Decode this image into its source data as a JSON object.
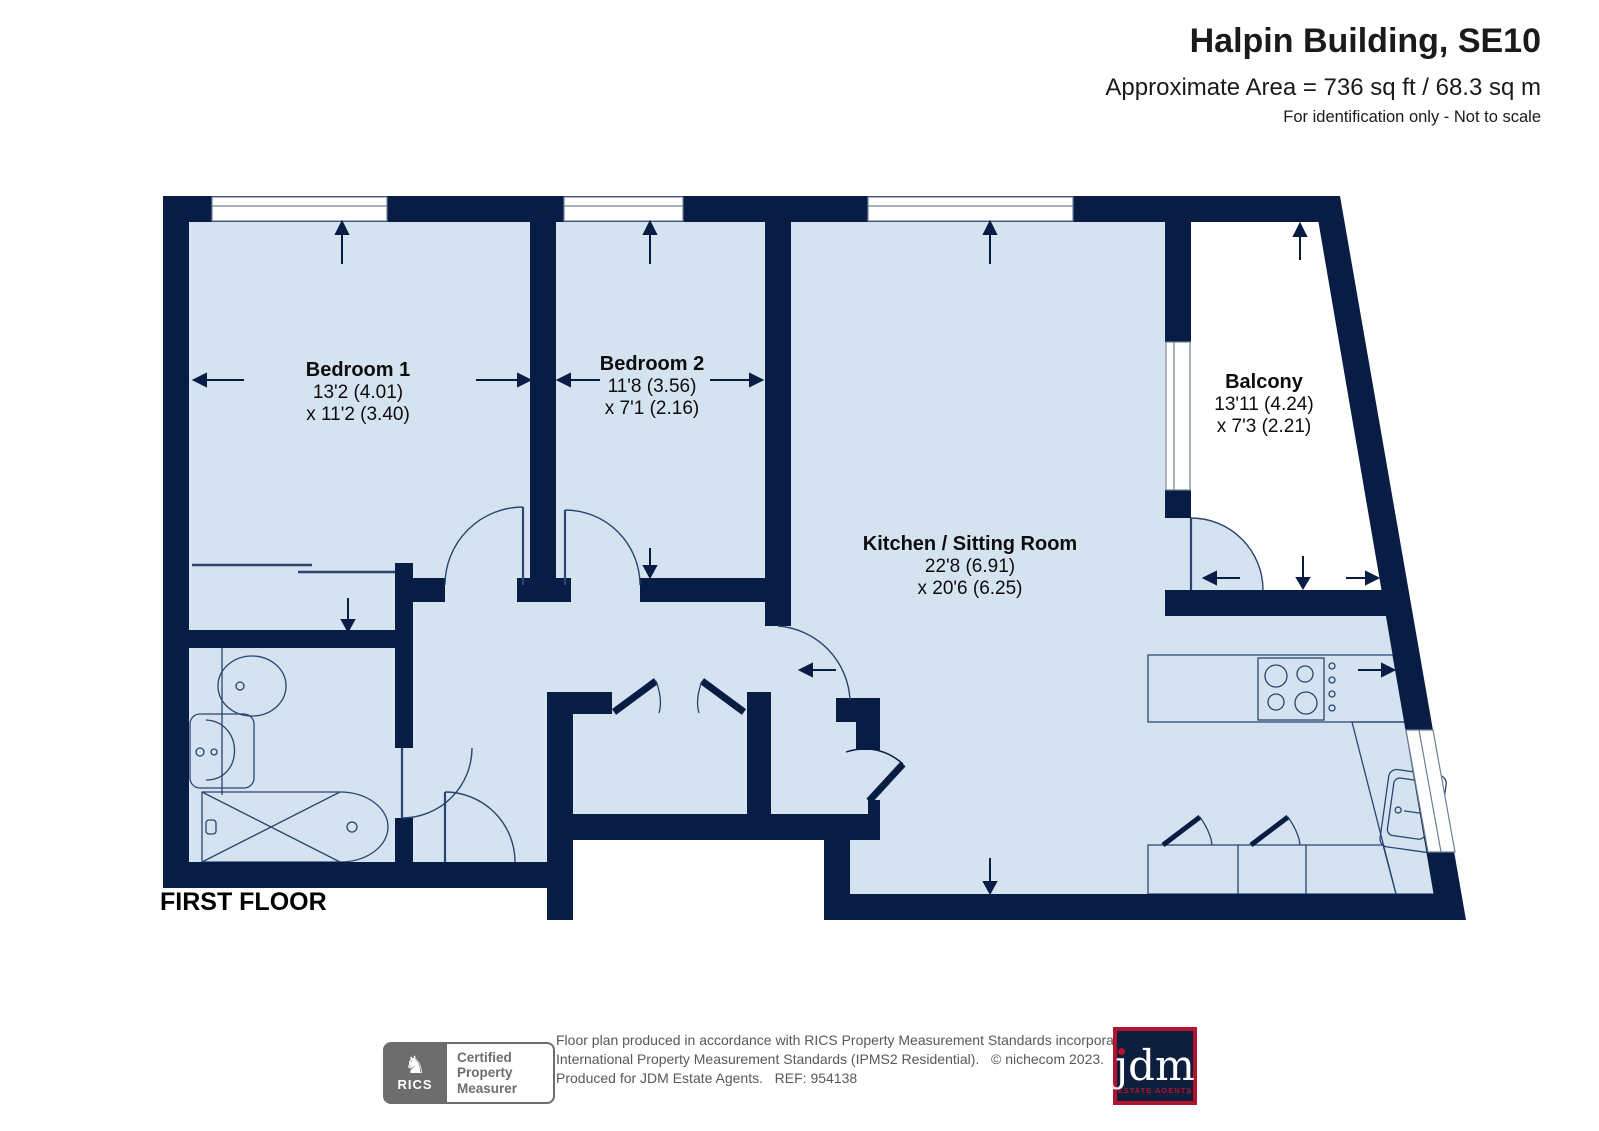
{
  "header": {
    "title": "Halpin Building, SE10",
    "area_line": "Approximate Area = 736 sq ft / 68.3 sq m",
    "note": "For identification only - Not to scale"
  },
  "plan": {
    "floor_label": "FIRST FLOOR",
    "rooms": [
      {
        "name": "Bedroom 1",
        "dim_line1": "13'2 (4.01)",
        "dim_line2": "x 11'2 (3.40)"
      },
      {
        "name": "Bedroom 2",
        "dim_line1": "11'8 (3.56)",
        "dim_line2": "x 7'1 (2.16)"
      },
      {
        "name": "Kitchen / Sitting Room",
        "dim_line1": "22'8 (6.91)",
        "dim_line2": "x 20'6 (6.25)"
      },
      {
        "name": "Balcony",
        "dim_line1": "13'11 (4.24)",
        "dim_line2": "x 7'3 (2.21)"
      }
    ]
  },
  "footer": {
    "rics_badge": {
      "glyph": "♞",
      "label": "RICS",
      "line1": "Certified",
      "line2": "Property",
      "line3": "Measurer"
    },
    "disclaimer": {
      "line1": "Floor plan produced in accordance with RICS Property Measurement Standards incorporating",
      "line2": "International Property Measurement Standards (IPMS2 Residential).   © nichecom 2023.",
      "line3": "Produced for JDM Estate Agents.   REF: 954138"
    },
    "jdm": {
      "name": "jdm",
      "tagline": "ESTATE AGENTS"
    }
  },
  "colors": {
    "wall": "#081c44",
    "room_fill": "#d5e2f0",
    "fixture_line": "#2a4570",
    "footer_gray": "#58585a",
    "jdm_red": "#b5122e",
    "jdm_navy": "#0d1f3c"
  }
}
